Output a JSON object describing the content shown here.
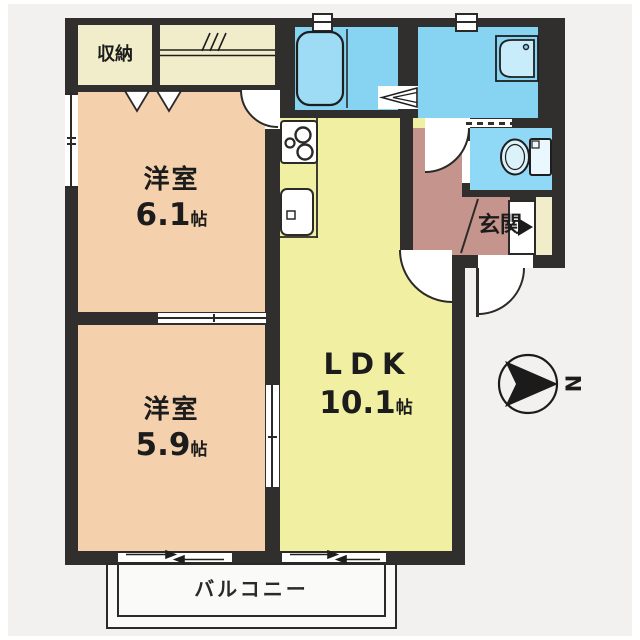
{
  "rooms": {
    "closet": {
      "label": "収納"
    },
    "bedroom1": {
      "name": "洋室",
      "size": "6.1",
      "unit": "帖"
    },
    "bedroom2": {
      "name": "洋室",
      "size": "5.9",
      "unit": "帖"
    },
    "ldk": {
      "name": "LDK",
      "size": "10.1",
      "unit": "帖"
    },
    "entrance": {
      "label": "玄関"
    },
    "balcony": {
      "label": "バルコニー"
    }
  },
  "compass": {
    "north_label": "N"
  },
  "colors": {
    "wall": "#312f2d",
    "bedroom": "#f4d1ac",
    "ldk": "#f1f0a2",
    "closet_cream": "#f1edca",
    "bath_cyan": "#87d3f2",
    "entrance_mauve": "#c5948d",
    "balcony_white": "#fafaf9",
    "background": "#f2f1ef"
  }
}
